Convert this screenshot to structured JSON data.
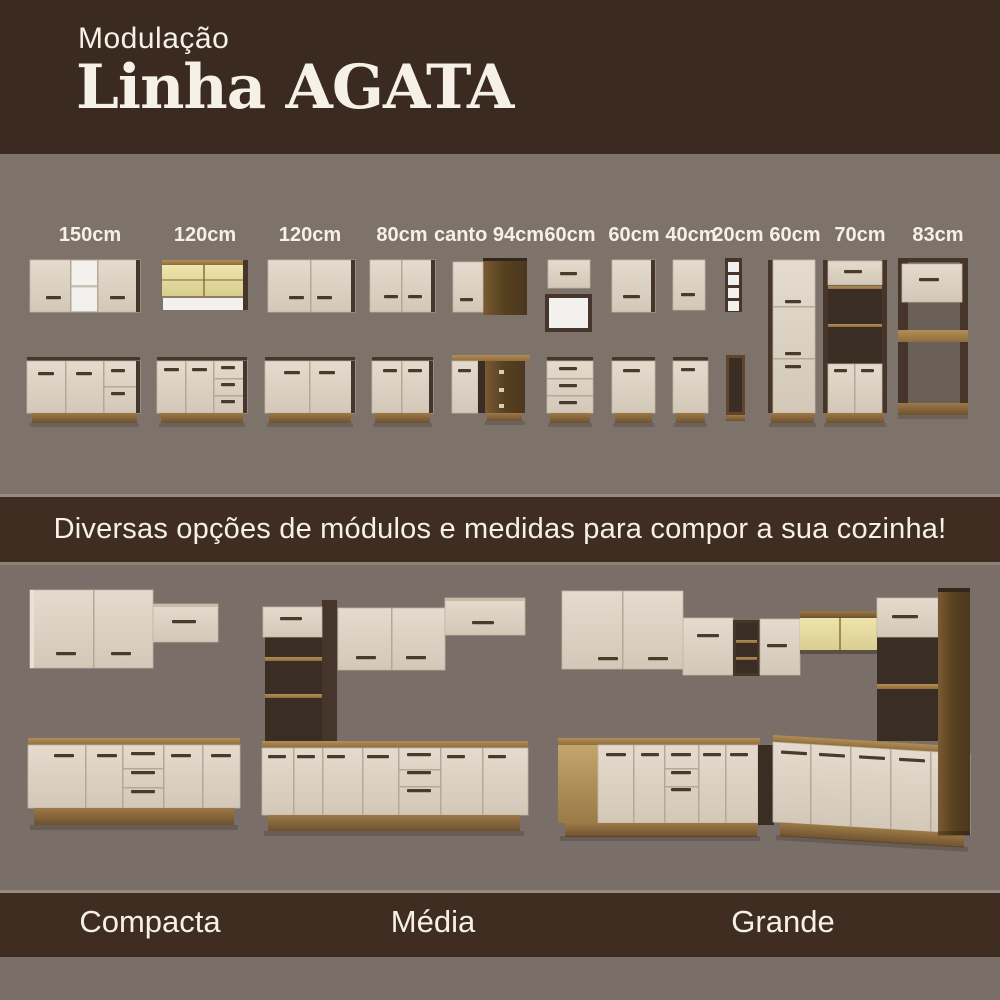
{
  "header": {
    "kicker": "Modulação",
    "title": "Linha AGATA"
  },
  "modules": {
    "labels": [
      "150cm",
      "120cm",
      "120cm",
      "80cm",
      "canto 94cm",
      "60cm",
      "60cm",
      "40cm",
      "20cm",
      "60cm",
      "70cm",
      "83cm"
    ]
  },
  "banner": {
    "text": "Diversas opções de módulos e medidas para compor a sua cozinha!"
  },
  "kitchens": [
    {
      "name": "Compacta"
    },
    {
      "name": "Média"
    },
    {
      "name": "Grande"
    }
  ],
  "colors": {
    "header_brown": "#3a2a20",
    "band_brown": "#3f2d22",
    "background_gray": "#7e736b",
    "background_gray_dark": "#7a6f68",
    "text_cream": "#f6f1e7",
    "door_cream": "#ddd3c5",
    "wood_brown": "#8a6a3f",
    "dark_panel": "#46352a",
    "interior_dark": "#3a2d24",
    "glass_yellow": "#e7db9f",
    "niche_white": "#f3f1ed",
    "handle_dark": "#4a3a2c"
  }
}
